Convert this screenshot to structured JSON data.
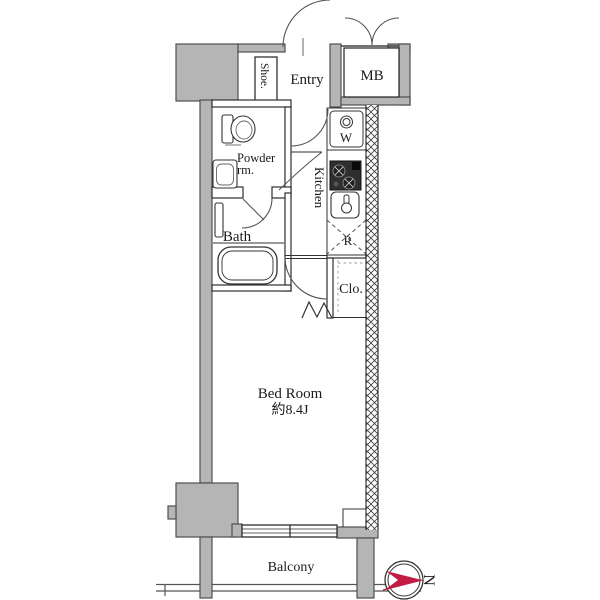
{
  "labels": {
    "shoe": "Shoe.",
    "entry": "Entry",
    "mb": "MB",
    "powder_line1": "Powder",
    "powder_line2": "rm.",
    "bath": "Bath",
    "kitchen": "Kitchen",
    "washer": "W",
    "fridge": "R",
    "closet": "Clo.",
    "bedroom_name": "Bed Room",
    "bedroom_size": "約8.4J",
    "balcony": "Balcony",
    "compass_north": "N"
  },
  "colors": {
    "wall_fill": "#b5b5b5",
    "wall_outline": "#4f4f4f",
    "line": "#2e2e2e",
    "compass_red": "#c21d44"
  }
}
